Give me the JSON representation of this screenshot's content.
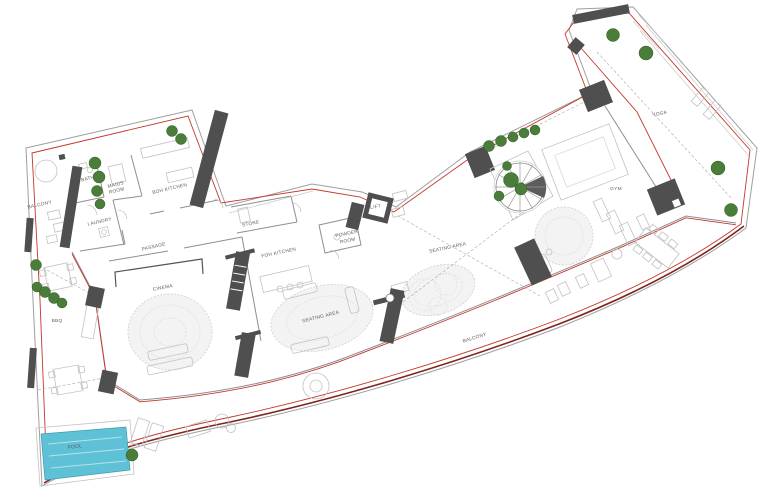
{
  "labels": {
    "balcony_left": "BALCONY",
    "bath": "BATH",
    "maids_line1": "MAIDS",
    "maids_line2": "ROOM",
    "boh_kitchen": "BOH KITCHEN",
    "laundry": "LAUNDRY",
    "passage": "PASSAGE",
    "store": "STORE",
    "foh_kitchen": "FOH KITCHEN",
    "powder_line1": "POWDER",
    "powder_line2": "ROOM",
    "lift": "LIFT",
    "cinema": "CINEMA",
    "bbq": "BBQ",
    "seating_area_main": "SEATING AREA",
    "seating_area_upper": "SEATING AREA",
    "gym": "GYM",
    "yoga": "YOGA",
    "pool": "POOL",
    "balcony_bottom": "BALCONY"
  },
  "colors": {
    "boundary_red": "#c4372b",
    "balcony_edge_dark": "#7e2420",
    "pool_water": "#5ec1d6",
    "pool_label": "#0e6b80",
    "plant_green": "#4a7c3a",
    "column_gray": "#4f4f4f"
  }
}
